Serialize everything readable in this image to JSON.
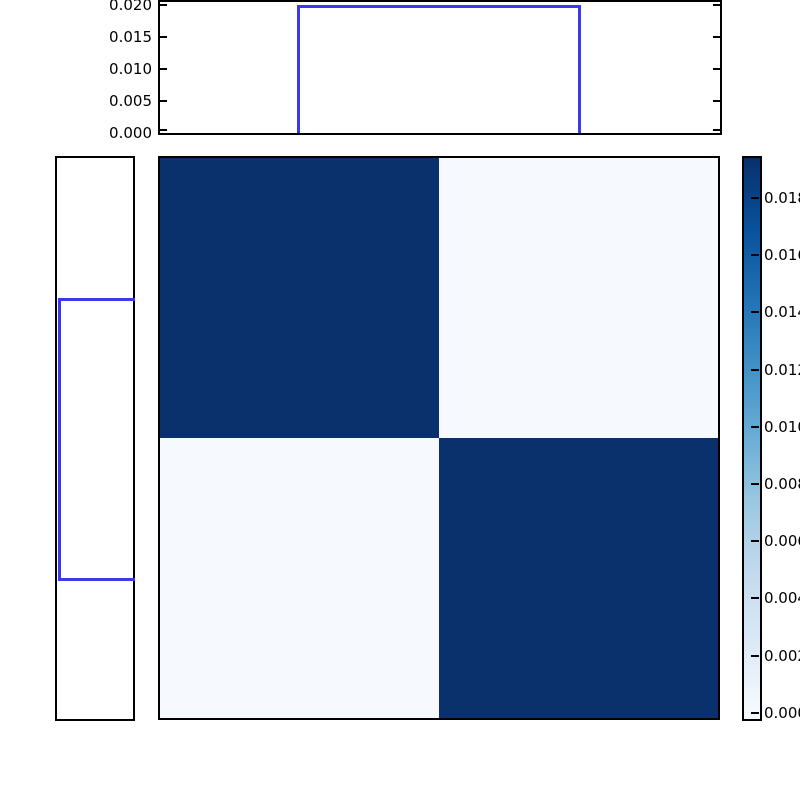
{
  "chart_data": {
    "type": "heatmap",
    "title": "",
    "description": "2x2 block joint-probability heatmap (Blues colormap) with marginal step histograms on top and left and a vertical colorbar on the right; figure is cropped at the top and right image edges",
    "heatmap": {
      "rows": 2,
      "cols": 2,
      "matrix": [
        [
          0.0195,
          0.0003
        ],
        [
          0.0003,
          0.0195
        ]
      ],
      "colormap": "Blues",
      "vmin": 0.0,
      "vmax": 0.0195,
      "color_high": "#0a316b",
      "color_low": "#f6fafe",
      "grid": false
    },
    "top_histogram": {
      "type": "step",
      "line_color": "#3a3ae6",
      "bar_value": 0.0197,
      "bar_support_fraction": [
        0.25,
        0.75
      ],
      "ylim": [
        0.0,
        0.0205
      ],
      "yticks": [
        0.0,
        0.005,
        0.01,
        0.015,
        0.02
      ],
      "ytick_labels": [
        "0.000",
        "0.005",
        "0.010",
        "0.015",
        "0.020"
      ],
      "xtick_labels": []
    },
    "left_histogram": {
      "type": "step",
      "orientation": "horizontal",
      "line_color": "#3a3ae6",
      "bar_value": 0.0197,
      "bar_support_fraction": [
        0.25,
        0.75
      ],
      "xtick_labels": [],
      "ytick_labels": []
    },
    "colorbar": {
      "orientation": "vertical",
      "ticks": [
        0.018,
        0.016,
        0.014,
        0.012,
        0.01,
        0.008,
        0.006,
        0.004,
        0.002,
        0.0
      ],
      "tick_labels": [
        "0.018",
        "0.016",
        "0.014",
        "0.012",
        "0.010",
        "0.008",
        "0.006",
        "0.004",
        "0.002",
        "0.000"
      ],
      "tick_labels_visible_clipped": [
        "0.01",
        "0.01",
        "0.01",
        "0.01",
        "0.01",
        "0.00",
        "0.00",
        "0.00",
        "0.00",
        "0.00"
      ],
      "gradient_stops": [
        "#08306b",
        "#08519c",
        "#2171b5",
        "#4292c6",
        "#6baed6",
        "#9ecae1",
        "#c6dbef",
        "#deebf7",
        "#f7fbff"
      ],
      "legend_position": "right"
    },
    "axis_color": "#000000"
  }
}
